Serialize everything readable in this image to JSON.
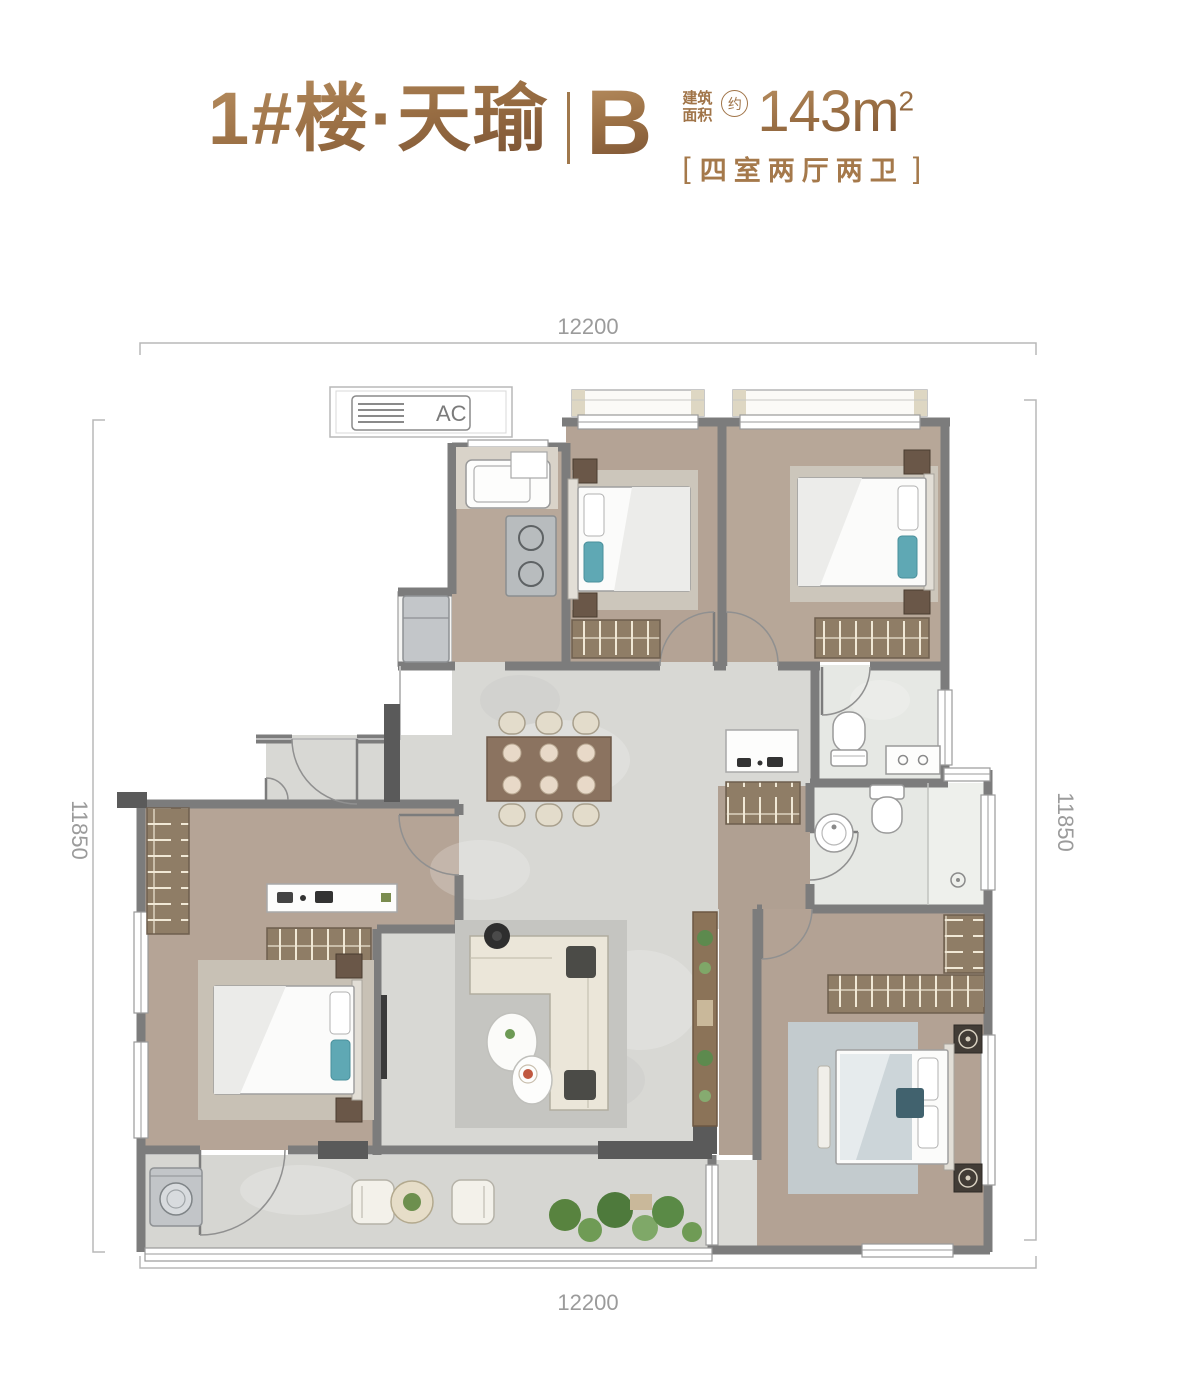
{
  "header": {
    "building": "1#楼·天瑜",
    "unit": "B",
    "area": {
      "label_line1": "建筑",
      "label_line2": "面积",
      "approx": "约",
      "value": "143m",
      "sup": "2"
    },
    "layout": {
      "bracket_left": "[",
      "text": "四室两厅两卫",
      "bracket_right": "]"
    }
  },
  "plan": {
    "ac_label": "AC",
    "dimensions": {
      "top": "12200",
      "bottom": "12200",
      "left": "11850",
      "right": "11850"
    },
    "colors": {
      "accent": "#9C7045",
      "wall": "#7C7C7C",
      "wood_floor": "#B6A696",
      "marble": "#D8D8D4",
      "tile": "#E6E8E4",
      "teal_pillow": "#5FA8B4"
    }
  }
}
